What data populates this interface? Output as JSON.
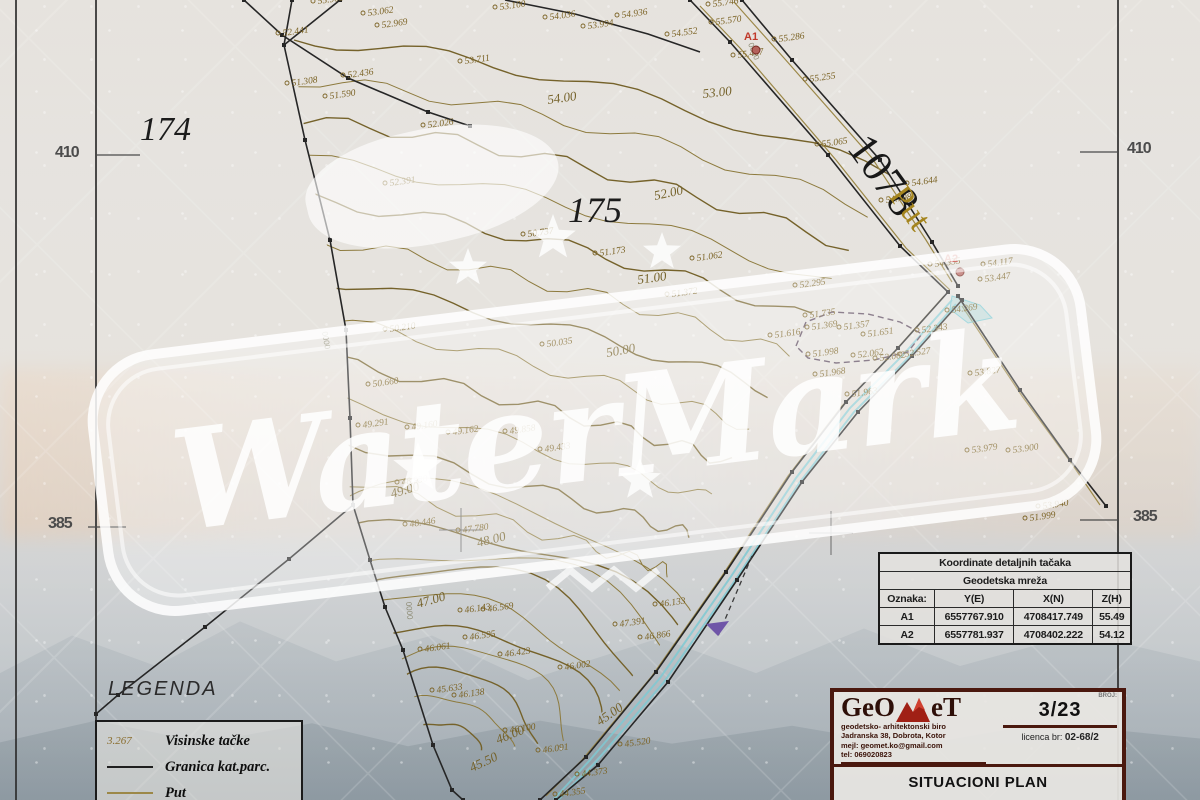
{
  "watermark": {
    "text": "WaterMark"
  },
  "frame": {
    "left_410": "410",
    "right_410": "410",
    "left_385": "385",
    "right_385": "385"
  },
  "legend": {
    "title": "LEGENDA",
    "items": [
      {
        "sample": "3.267",
        "label": "Visinske tačke"
      },
      {
        "label": "Granica kat.parc."
      },
      {
        "label": "Put"
      }
    ]
  },
  "table": {
    "title": "Koordinate detaljnih tačaka",
    "subtitle": "Geodetska mreža",
    "headers": [
      "Oznaka:",
      "Y(E)",
      "X(N)",
      "Z(H)"
    ],
    "rows": [
      [
        "A1",
        "6557767.910",
        "4708417.749",
        "55.49"
      ],
      [
        "A2",
        "6557781.937",
        "4708402.222",
        "54.12"
      ]
    ]
  },
  "title_block": {
    "logo_left": "GeO",
    "logo_right": "eT",
    "line1": "geodetsko- arhitektonski biro",
    "line2": "Jadranska 38, Dobrota, Kotor",
    "line3": "mejl: geomet.ko@gmail.com",
    "line4": "tel: 069020823",
    "broj_label": "BROJ:",
    "sheet": "3/23",
    "licenca_label": "licenca br:",
    "licenca_value": "02-68/2",
    "title": "SITUACIONI PLAN"
  },
  "colors": {
    "contour": "#8d7a3d",
    "contour_dark": "#75622a",
    "label": "#7c6426",
    "black": "#262626",
    "cyan": "#7fc9d2",
    "red": "#c0392b",
    "road": "#9c8848",
    "purple": "#5c4a5e",
    "arrow_purple": "#6f55a8"
  },
  "map": {
    "clip": [
      [
        288,
        0
      ],
      [
        748,
        0
      ],
      [
        890,
        158
      ],
      [
        958,
        292
      ],
      [
        820,
        430
      ],
      [
        700,
        600
      ],
      [
        622,
        688
      ],
      [
        540,
        788
      ],
      [
        468,
        800
      ],
      [
        430,
        745
      ],
      [
        385,
        607
      ],
      [
        350,
        500
      ],
      [
        346,
        330
      ],
      [
        282,
        45
      ]
    ],
    "contours": {
      "arcs": {
        "cx": 440,
        "cy": 755,
        "sx": 1.18,
        "sy": 0.96,
        "n": 10,
        "r0": 34,
        "dr": 26,
        "a0": 176,
        "a1": 6
      },
      "upper": {
        "n": 12,
        "amp": 7,
        "p0": [
          294,
          40
        ],
        "dp0": [
          5,
          40
        ],
        "p1": [
          560,
          55
        ],
        "dp1": [
          8,
          46
        ],
        "p2": [
          890,
          175
        ],
        "dp2": [
          -20,
          36
        ]
      }
    },
    "black": [
      {
        "p": [
          [
            340,
            0
          ],
          [
            284,
            45
          ]
        ],
        "v": true
      },
      {
        "p": [
          [
            292,
            0
          ],
          [
            284,
            45
          ],
          [
            305,
            140
          ],
          [
            330,
            240
          ],
          [
            346,
            330
          ],
          [
            350,
            418
          ],
          [
            353,
            505
          ]
        ],
        "v": true
      },
      {
        "p": [
          [
            353,
            505
          ],
          [
            289,
            559
          ],
          [
            205,
            627
          ],
          [
            118,
            695
          ],
          [
            96,
            714
          ]
        ],
        "v": true
      },
      {
        "p": [
          [
            353,
            505
          ],
          [
            370,
            560
          ],
          [
            385,
            607
          ],
          [
            403,
            650
          ],
          [
            433,
            745
          ],
          [
            452,
            790
          ],
          [
            463,
            800
          ]
        ],
        "v": true
      },
      {
        "p": [
          [
            244,
            0
          ],
          [
            282,
            35
          ],
          [
            348,
            78
          ],
          [
            428,
            112
          ],
          [
            470,
            126
          ]
        ],
        "v": true
      },
      {
        "p": [
          [
            505,
            0
          ],
          [
            575,
            14
          ],
          [
            648,
            34
          ],
          [
            700,
            52
          ]
        ],
        "v": false
      },
      {
        "p": [
          [
            690,
            0
          ],
          [
            730,
            42
          ],
          [
            828,
            155
          ],
          [
            900,
            246
          ],
          [
            948,
            292
          ]
        ],
        "v": true
      },
      {
        "p": [
          [
            742,
            0
          ],
          [
            792,
            60
          ],
          [
            880,
            160
          ],
          [
            932,
            242
          ],
          [
            958,
            286
          ]
        ],
        "v": true
      },
      {
        "p": [
          [
            948,
            292
          ],
          [
            898,
            348
          ],
          [
            846,
            402
          ],
          [
            792,
            472
          ],
          [
            726,
            572
          ],
          [
            656,
            672
          ],
          [
            586,
            757
          ],
          [
            540,
            800
          ]
        ],
        "v": true
      },
      {
        "p": [
          [
            962,
            300
          ],
          [
            912,
            356
          ],
          [
            858,
            412
          ],
          [
            802,
            482
          ],
          [
            737,
            580
          ],
          [
            668,
            682
          ],
          [
            598,
            765
          ],
          [
            556,
            800
          ]
        ],
        "v": true
      },
      {
        "p": [
          [
            958,
            296
          ],
          [
            1020,
            390
          ],
          [
            1070,
            460
          ],
          [
            1106,
            506
          ]
        ],
        "v": true
      }
    ],
    "olive": [
      [
        [
          700,
          6
        ],
        [
          740,
          48
        ],
        [
          836,
          160
        ],
        [
          906,
          248
        ],
        [
          950,
          290
        ]
      ],
      [
        [
          734,
          2
        ],
        [
          784,
          58
        ],
        [
          872,
          158
        ],
        [
          926,
          240
        ],
        [
          952,
          282
        ]
      ],
      [
        [
          944,
          296
        ],
        [
          894,
          352
        ],
        [
          842,
          406
        ],
        [
          788,
          476
        ],
        [
          722,
          576
        ],
        [
          652,
          676
        ],
        [
          582,
          760
        ],
        [
          546,
          796
        ]
      ],
      [
        [
          962,
          306
        ],
        [
          1022,
          396
        ],
        [
          1072,
          464
        ],
        [
          1100,
          505
        ]
      ]
    ],
    "cyan": [
      [
        [
          952,
          300
        ],
        [
          902,
          356
        ],
        [
          850,
          408
        ],
        [
          796,
          478
        ],
        [
          730,
          578
        ],
        [
          660,
          678
        ],
        [
          590,
          760
        ],
        [
          554,
          799
        ]
      ],
      [
        [
          956,
          304
        ],
        [
          906,
          360
        ],
        [
          854,
          412
        ],
        [
          800,
          482
        ],
        [
          734,
          582
        ],
        [
          664,
          682
        ],
        [
          594,
          764
        ],
        [
          558,
          800
        ]
      ]
    ],
    "cyan_poly": [
      [
        952,
        296
      ],
      [
        980,
        305
      ],
      [
        992,
        318
      ],
      [
        968,
        323
      ],
      [
        950,
        309
      ]
    ],
    "dashed_poly": [
      [
        796,
        346
      ],
      [
        806,
        322
      ],
      [
        832,
        312
      ],
      [
        868,
        314
      ],
      [
        900,
        322
      ],
      [
        922,
        334
      ],
      [
        908,
        352
      ],
      [
        874,
        360
      ],
      [
        836,
        363
      ],
      [
        808,
        358
      ]
    ],
    "arrow": {
      "line": [
        [
          752,
          556
        ],
        [
          718,
          636
        ]
      ],
      "head": [
        [
          718,
          636
        ],
        [
          729,
          621
        ],
        [
          706,
          624
        ]
      ]
    },
    "ticks": [
      [
        95,
        155,
        140,
        155
      ],
      [
        1080,
        152,
        1118,
        152
      ],
      [
        88,
        527,
        126,
        527
      ],
      [
        1080,
        520,
        1118,
        520
      ]
    ],
    "crosses": [
      [
        461,
        530
      ],
      [
        831,
        533
      ]
    ],
    "big": [
      {
        "t": "174",
        "x": 140,
        "y": 140,
        "size": 34,
        "it": true,
        "fill": "#1c1c1c"
      },
      {
        "t": "175",
        "x": 568,
        "y": 222,
        "size": 36,
        "it": true,
        "fill": "#1c1c1c"
      },
      {
        "t": "1078",
        "x": 846,
        "y": 148,
        "size": 44,
        "rot": 54,
        "fill": "#181818"
      },
      {
        "t": "Put",
        "x": 888,
        "y": 196,
        "size": 34,
        "rot": 54,
        "fill": "#a5851e"
      }
    ],
    "red": [
      {
        "t": "A1",
        "x": 744,
        "y": 40,
        "cx": 756,
        "cy": 50
      },
      {
        "t": "A2",
        "x": 944,
        "y": 262,
        "cx": 960,
        "cy": 272
      }
    ],
    "points": [
      [
        318,
        4,
        "55.908"
      ],
      [
        368,
        16,
        "53.062"
      ],
      [
        382,
        28,
        "52.969"
      ],
      [
        283,
        36,
        "52.441"
      ],
      [
        292,
        86,
        "51.308"
      ],
      [
        330,
        99,
        "51.590"
      ],
      [
        428,
        128,
        "52.026"
      ],
      [
        348,
        78,
        "52.436"
      ],
      [
        390,
        186,
        "52.391"
      ],
      [
        465,
        64,
        "53.711"
      ],
      [
        500,
        10,
        "53.100"
      ],
      [
        550,
        20,
        "54.036"
      ],
      [
        588,
        29,
        "53.994"
      ],
      [
        622,
        18,
        "54.936"
      ],
      [
        672,
        37,
        "54.552"
      ],
      [
        713,
        7,
        "55.746"
      ],
      [
        716,
        25,
        "55.570"
      ],
      [
        738,
        58,
        "55.467"
      ],
      [
        779,
        42,
        "55.286"
      ],
      [
        810,
        82,
        "55.255"
      ],
      [
        822,
        147,
        "55.065"
      ],
      [
        912,
        186,
        "54.644"
      ],
      [
        886,
        203,
        "54.798"
      ],
      [
        935,
        267,
        "54.335"
      ],
      [
        988,
        267,
        "54.117"
      ],
      [
        985,
        282,
        "53.447"
      ],
      [
        952,
        313,
        "54.269"
      ],
      [
        922,
        333,
        "52.343"
      ],
      [
        975,
        376,
        "53.827"
      ],
      [
        972,
        453,
        "53.979"
      ],
      [
        1013,
        453,
        "53.900"
      ],
      [
        1043,
        509,
        "53.940"
      ],
      [
        1030,
        521,
        "51.999"
      ],
      [
        528,
        237,
        "50.737"
      ],
      [
        600,
        256,
        "51.173"
      ],
      [
        697,
        261,
        "51.062"
      ],
      [
        672,
        297,
        "51.372"
      ],
      [
        775,
        338,
        "51.616"
      ],
      [
        800,
        288,
        "52.295"
      ],
      [
        810,
        318,
        "51.735"
      ],
      [
        812,
        330,
        "51.369"
      ],
      [
        844,
        330,
        "51.357"
      ],
      [
        868,
        337,
        "51.651"
      ],
      [
        813,
        357,
        "51.998"
      ],
      [
        858,
        358,
        "52.062"
      ],
      [
        880,
        361,
        "52.082"
      ],
      [
        905,
        357,
        "52.527"
      ],
      [
        820,
        377,
        "51.968"
      ],
      [
        852,
        397,
        "51.963"
      ],
      [
        390,
        332,
        "50.210"
      ],
      [
        547,
        347,
        "50.035"
      ],
      [
        373,
        387,
        "50.660"
      ],
      [
        363,
        428,
        "49.291"
      ],
      [
        412,
        430,
        "49.160"
      ],
      [
        453,
        435,
        "49.162"
      ],
      [
        510,
        434,
        "49.858"
      ],
      [
        545,
        452,
        "49.433"
      ],
      [
        402,
        485,
        "48.930"
      ],
      [
        410,
        527,
        "48.446"
      ],
      [
        463,
        533,
        "47.780"
      ],
      [
        465,
        613,
        "46.143"
      ],
      [
        488,
        612,
        "46.569"
      ],
      [
        470,
        640,
        "46.595"
      ],
      [
        425,
        652,
        "46.061"
      ],
      [
        437,
        693,
        "45.633"
      ],
      [
        459,
        698,
        "46.138"
      ],
      [
        505,
        657,
        "46.423"
      ],
      [
        565,
        670,
        "46.002"
      ],
      [
        660,
        607,
        "46.133"
      ],
      [
        620,
        627,
        "47.391"
      ],
      [
        645,
        640,
        "46.866"
      ],
      [
        510,
        733,
        "46.100"
      ],
      [
        543,
        753,
        "46.091"
      ],
      [
        625,
        747,
        "45.520"
      ],
      [
        582,
        777,
        "44.373"
      ],
      [
        560,
        797,
        "44.355"
      ]
    ],
    "contour_labels": [
      [
        "53.00",
        703,
        98,
        -6
      ],
      [
        "54.00",
        548,
        104,
        -8
      ],
      [
        "52.00",
        655,
        200,
        -12
      ],
      [
        "51.00",
        638,
        284,
        -8
      ],
      [
        "50.00",
        607,
        357,
        -10
      ],
      [
        "49.00",
        392,
        498,
        -16
      ],
      [
        "48.00",
        478,
        547,
        -14
      ],
      [
        "47.00",
        418,
        608,
        -16
      ],
      [
        "46.00",
        498,
        744,
        -22
      ],
      [
        "45.00",
        600,
        726,
        -35
      ],
      [
        "45.50",
        472,
        772,
        -25
      ]
    ],
    "rot_labels": [
      [
        322,
        332,
        "0000",
        80
      ],
      [
        406,
        602,
        "0000",
        85
      ],
      [
        748,
        44,
        "0000",
        68
      ]
    ],
    "stars": [
      [
        468,
        268,
        20
      ],
      [
        553,
        238,
        24
      ],
      [
        662,
        252,
        20
      ],
      [
        418,
        468,
        26
      ],
      [
        640,
        480,
        22
      ]
    ],
    "zigzag": [
      [
        548,
        588
      ],
      [
        570,
        570
      ],
      [
        592,
        588
      ],
      [
        614,
        570
      ],
      [
        636,
        588
      ],
      [
        658,
        570
      ]
    ]
  }
}
